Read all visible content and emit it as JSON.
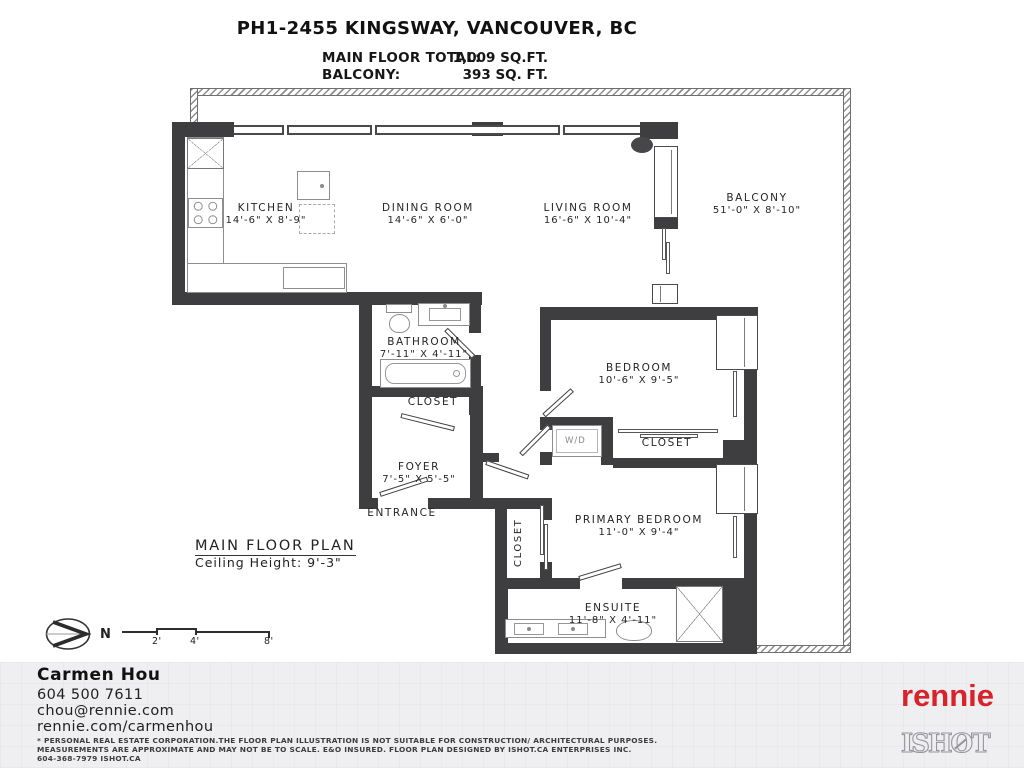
{
  "header": {
    "title": "PH1-2455 KINGSWAY, VANCOUVER, BC",
    "rows": [
      {
        "label": "MAIN FLOOR TOTAL:",
        "value": "1,009 SQ.FT."
      },
      {
        "label": "BALCONY:",
        "value": "393 SQ. FT."
      }
    ]
  },
  "rooms": {
    "kitchen": {
      "name": "KITCHEN",
      "dims": "14'-6\" X 8'-9\""
    },
    "dining": {
      "name": "DINING ROOM",
      "dims": "14'-6\" X 6'-0\""
    },
    "living": {
      "name": "LIVING ROOM",
      "dims": "16'-6\" X 10'-4\""
    },
    "balcony": {
      "name": "BALCONY",
      "dims": "51'-0\" X 8'-10\""
    },
    "bathroom": {
      "name": "BATHROOM",
      "dims": "7'-11\" X 4'-11\""
    },
    "closet_hall": {
      "name": "CLOSET"
    },
    "foyer": {
      "name": "FOYER",
      "dims": "7'-5\" X 5'-5\""
    },
    "entrance": {
      "name": "ENTRANCE"
    },
    "bedroom": {
      "name": "BEDROOM",
      "dims": "10'-6\" X 9'-5\""
    },
    "wd": {
      "name": "W/D"
    },
    "closet_bedroom": {
      "name": "CLOSET"
    },
    "primary": {
      "name": "PRIMARY BEDROOM",
      "dims": "11'-0\" X 9'-4\""
    },
    "closet_primary": {
      "name": "CLOSET"
    },
    "ensuite": {
      "name": "ENSUITE",
      "dims": "11'-8\" X 4'-11\""
    }
  },
  "plan": {
    "title": "MAIN FLOOR PLAN",
    "subtitle": "Ceiling Height: 9'-3\"",
    "north": "N",
    "scale_ticks": [
      "2'",
      "4'",
      "8'"
    ]
  },
  "footer": {
    "agent_name": "Carmen Hou",
    "phone": "604 500 7611",
    "email": "chou@rennie.com",
    "website": "rennie.com/carmenhou",
    "disclaimer_line1": "* PERSONAL REAL ESTATE CORPORATION.THE FLOOR PLAN ILLUSTRATION IS NOT SUITABLE FOR CONSTRUCTION/ ARCHITECTURAL PURPOSES.",
    "disclaimer_line2": "MEASUREMENTS ARE APPROXIMATE AND MAY NOT BE TO SCALE. E&O INSURED. FLOOR PLAN DESIGNED BY ISHOT.CA ENTERPRISES INC.",
    "disclaimer_line3": "604-368-7979  ISHOT.CA",
    "brand": "rennie",
    "designer": {
      "l1": "I",
      "l2": "S",
      "l3": "H",
      "l4": "O",
      "l5": "T"
    }
  },
  "colors": {
    "wall": "#3e3e40",
    "brand_red": "#d8232a",
    "footer_bg": "#efeef0"
  }
}
